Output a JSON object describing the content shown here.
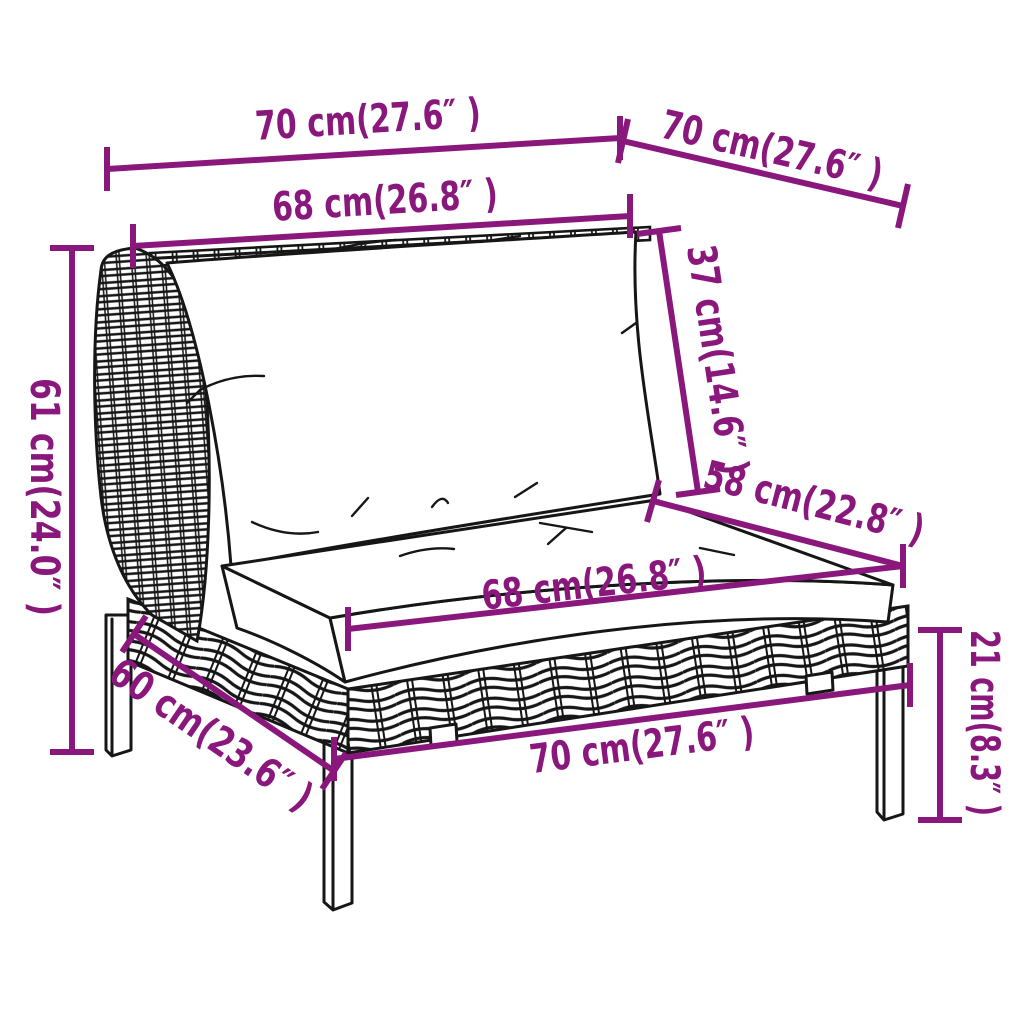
{
  "colors": {
    "dimension_accent": "#8a187c",
    "line_art": "#161616",
    "background": "#ffffff"
  },
  "diagram": {
    "kind": "furniture-dimension-line-drawing",
    "subject": "poly rattan garden sofa middle section with back and seat cushions",
    "dimensions": {
      "back_top_width": {
        "label": "70 cm(27.6″ )",
        "cm": 70,
        "inches": 27.6
      },
      "side_top_depth": {
        "label": "70 cm(27.6″ )",
        "cm": 70,
        "inches": 27.6
      },
      "back_cushion_width": {
        "label": "68 cm(26.8″ )",
        "cm": 68,
        "inches": 26.8
      },
      "back_cushion_height": {
        "label": "37 cm(14.6″ )",
        "cm": 37,
        "inches": 14.6
      },
      "total_height": {
        "label": "61 cm(24.0″ )",
        "cm": 61,
        "inches": 24.0
      },
      "seat_depth": {
        "label": "58 cm(22.8″ )",
        "cm": 58,
        "inches": 22.8
      },
      "seat_cushion_width": {
        "label": "68 cm(26.8″ )",
        "cm": 68,
        "inches": 26.8
      },
      "seat_height": {
        "label": "21 cm(8.3″ )",
        "cm": 21,
        "inches": 8.3
      },
      "base_depth": {
        "label": "60 cm(23.6″ )",
        "cm": 60,
        "inches": 23.6
      },
      "base_front_width": {
        "label": "70 cm(27.6″ )",
        "cm": 70,
        "inches": 27.6
      }
    }
  }
}
